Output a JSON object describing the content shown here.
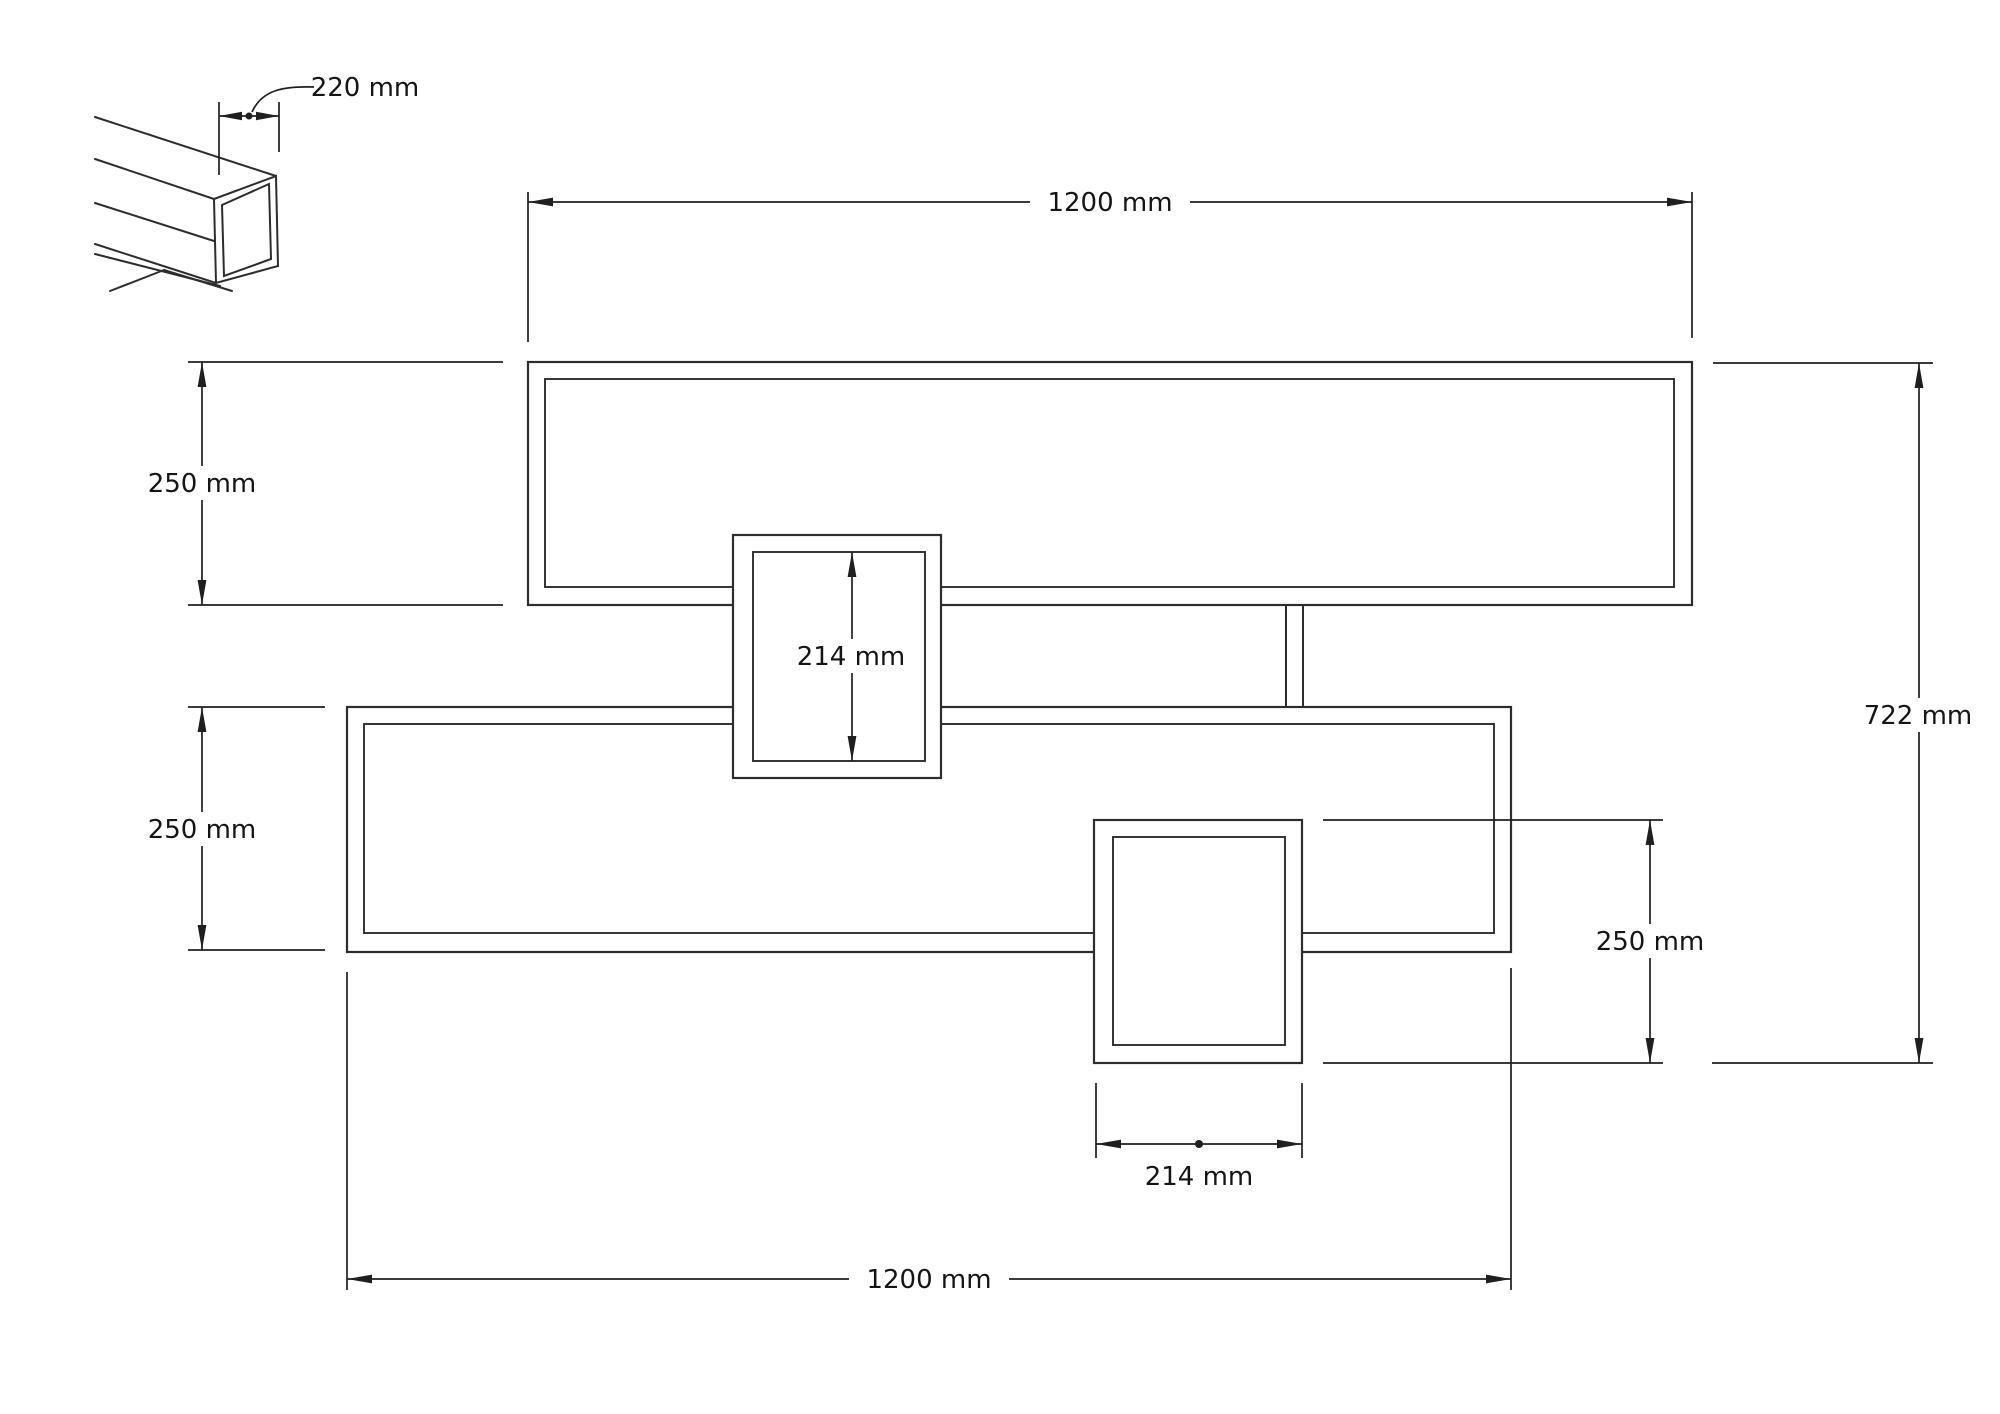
{
  "drawing": {
    "kind": "furniture shelf technical drawing",
    "colors": {
      "line": "#2d2d2d",
      "dimension_line": "#1f1f1f",
      "background": "#ffffff"
    },
    "views": {
      "detail_view": "isometric-corner-detail",
      "front_view": "front-elevation"
    },
    "dimensions": {
      "detail_depth": {
        "label": "220 mm",
        "value_mm": 220
      },
      "top_width": {
        "label": "1200 mm",
        "value_mm": 1200
      },
      "upper_left_height": {
        "label": "250 mm",
        "value_mm": 250
      },
      "middle_box_height": {
        "label": "214 mm",
        "value_mm": 214
      },
      "lower_left_height": {
        "label": "250 mm",
        "value_mm": 250
      },
      "total_height": {
        "label": "722 mm",
        "value_mm": 722
      },
      "right_box_height": {
        "label": "250 mm",
        "value_mm": 250
      },
      "bottom_box_width": {
        "label": "214 mm",
        "value_mm": 214
      },
      "bottom_width": {
        "label": "1200 mm",
        "value_mm": 1200
      }
    }
  }
}
